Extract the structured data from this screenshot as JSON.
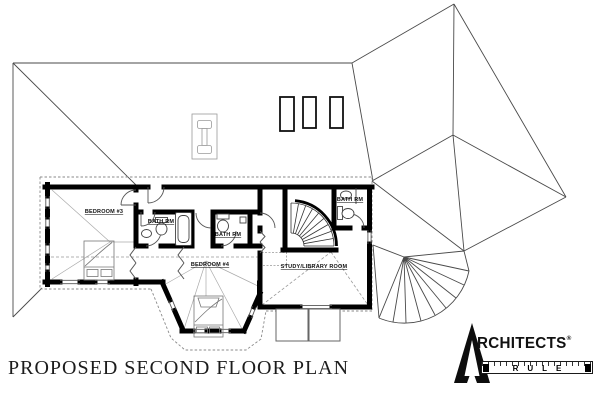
{
  "title": "PROPOSED SECOND FLOOR PLAN",
  "rooms": {
    "bedroom3": "BEDROOM #3",
    "bedroom4": "BEDROOM #4",
    "bath_left": "BATH RM",
    "bath_mid": "BATH RM",
    "bath_right": "BATH RM",
    "study": "STUDY/LIBRARY ROOM"
  },
  "logo": {
    "brand_initial": "A",
    "brand_rest": "RCHITECTS",
    "registered_mark": "®",
    "ruler_word": "RULE"
  },
  "colors": {
    "wall": "#000000",
    "roof_line": "#4a4a4a",
    "overhang_dash": "#8a8a8a",
    "background": "#ffffff"
  }
}
